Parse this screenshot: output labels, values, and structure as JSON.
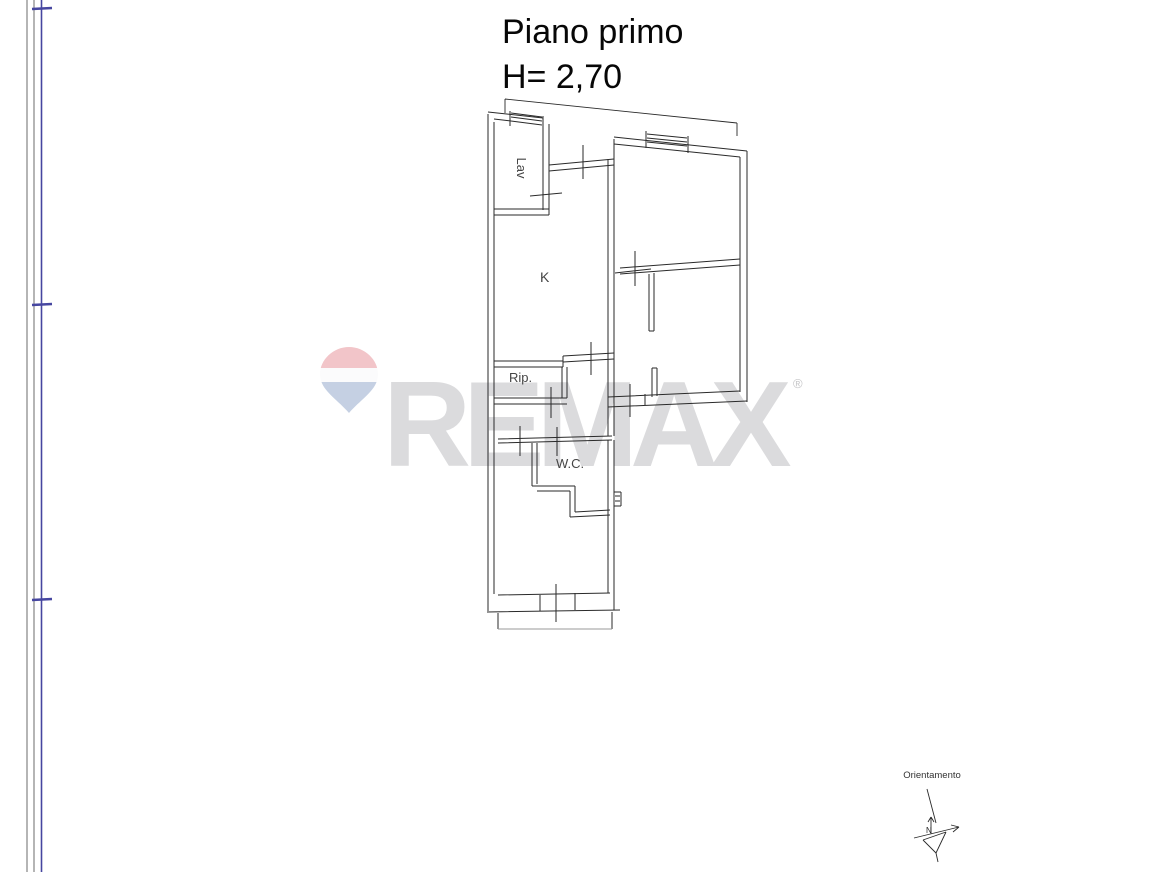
{
  "title": {
    "line1": "Piano primo",
    "line2": "H= 2,70"
  },
  "plan": {
    "labels": {
      "lav": "Lav",
      "kitchen": "K",
      "rip": "Rip.",
      "wc": "W.C."
    }
  },
  "compass": {
    "label": "Orientamento",
    "north_letter": "N"
  },
  "watermark": {
    "brand": "REMAX",
    "registered": "®"
  },
  "colors": {
    "line": "#2a2a2a",
    "guide_blue": "#4646a0",
    "wm_text": "#dbdbdd",
    "balloon_top": "#f2c5c9",
    "balloon_mid": "#fbfbfc",
    "balloon_bottom": "#c5d0e3"
  }
}
